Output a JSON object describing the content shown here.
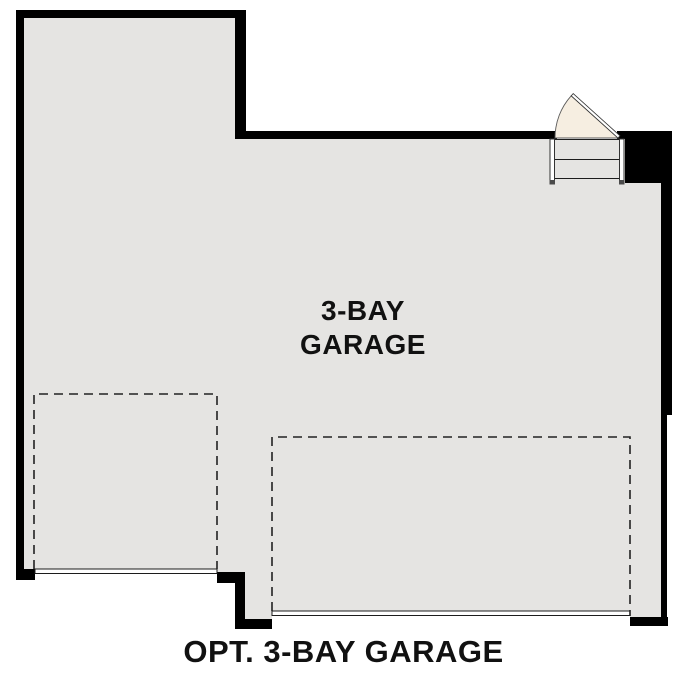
{
  "plan": {
    "room_label": {
      "line1": "3-BAY",
      "line2": "GARAGE"
    },
    "caption": "OPT. 3-BAY GARAGE",
    "colors": {
      "background": "#ffffff",
      "wall": "#000000",
      "floor": "#e5e4e2",
      "door_swing_fill": "#f6eee1",
      "line": "#1c1c1c",
      "text": "#111111"
    },
    "features": {
      "entry_door": "entry-door-swing",
      "entry_steps": "entry-steps",
      "left_bay_outline": "optional-single-bay-dashed",
      "right_bay_outline": "optional-double-bay-dashed",
      "left_garage_door": "garage-door-opening-left",
      "right_garage_door": "garage-door-opening-right"
    }
  }
}
